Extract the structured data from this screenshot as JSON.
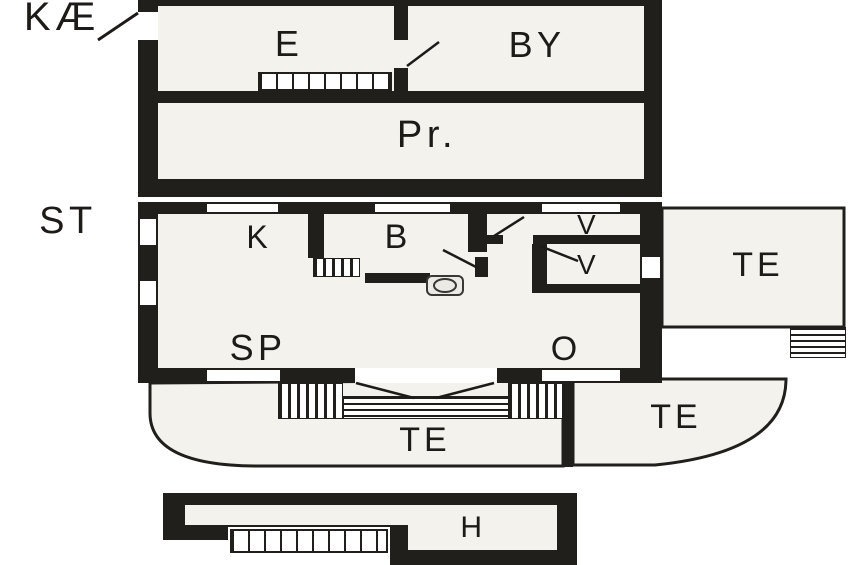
{
  "colors": {
    "wall": "#211f1b",
    "interior": "#f4f2ec",
    "background": "#ffffff",
    "line": "#1d1b17"
  },
  "plan": {
    "upper_floor": {
      "name_label": "KÆ",
      "rooms": {
        "e": "E",
        "by": "BY",
        "pr": "Pr."
      }
    },
    "ground_floor": {
      "name_label": "ST",
      "rooms": {
        "k": "K",
        "b": "B",
        "v_north": "V",
        "v_south": "V",
        "sp": "SP",
        "o": "O"
      }
    },
    "terraces": {
      "south": "TE",
      "southeast": "TE",
      "east": "TE"
    },
    "outbuilding": {
      "h": "H"
    }
  }
}
